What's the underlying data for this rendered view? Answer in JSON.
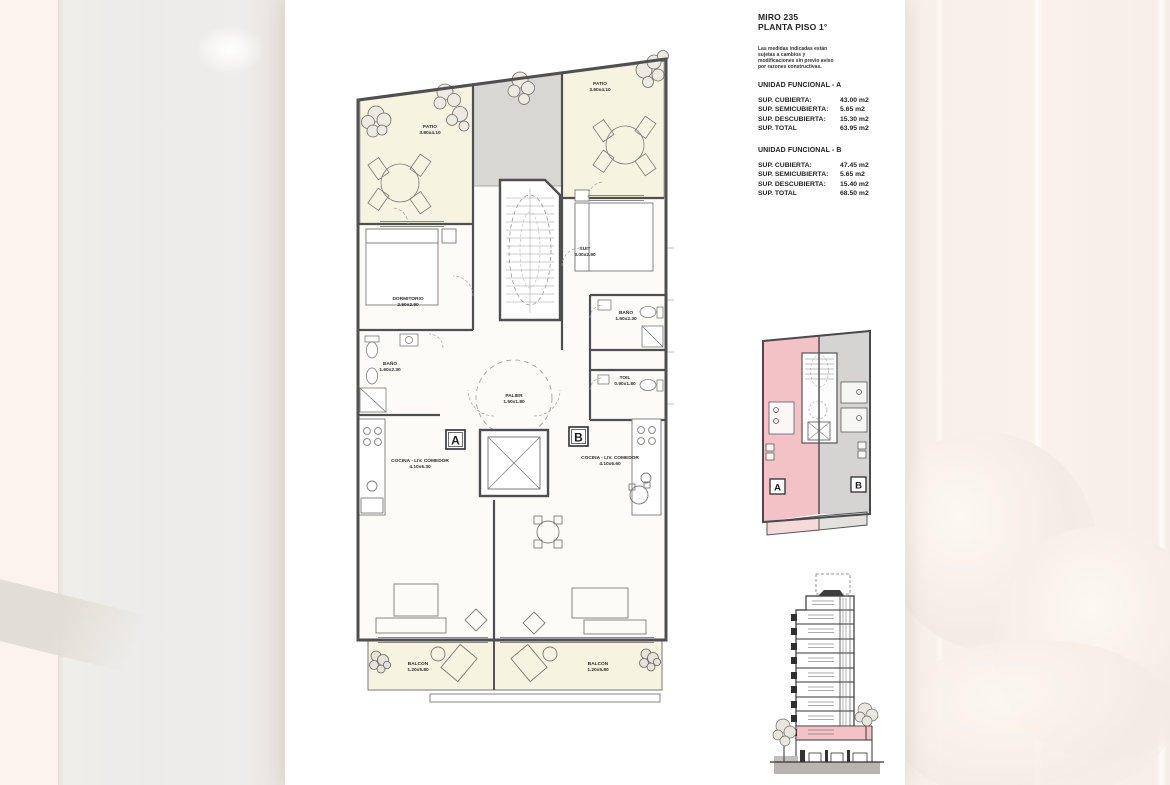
{
  "title_block": {
    "project": "MIRO 235",
    "sheet": "PLANTA PISO 1°",
    "disclaimer_lines": [
      "Las medidas indicadas están",
      "sujetas a cambios y",
      "modificaciones sin previo aviso",
      "por razones constructivas."
    ]
  },
  "units": [
    {
      "heading": "UNIDAD FUNCIONAL - A",
      "rows": [
        {
          "label": "SUP. CUBIERTA:",
          "value": "43.00 m2"
        },
        {
          "label": "SUP. SEMICUBIERTA:",
          "value": "5.65 m2"
        },
        {
          "label": "SUP. DESCUBIERTA:",
          "value": "15.30 m2"
        },
        {
          "label": "SUP. TOTAL",
          "value": "63.95 m2"
        }
      ]
    },
    {
      "heading": "UNIDAD FUNCIONAL - B",
      "rows": [
        {
          "label": "SUP. CUBIERTA:",
          "value": "47.45 m2"
        },
        {
          "label": "SUP. SEMICUBIERTA:",
          "value": "5.65 m2"
        },
        {
          "label": "SUP. DESCUBIERTA:",
          "value": "15.40 m2"
        },
        {
          "label": "SUP. TOTAL",
          "value": "68.50 m2"
        }
      ]
    }
  ],
  "plan": {
    "rooms": {
      "patio_a": {
        "name": "PATIO",
        "dim": "3.80x4.10"
      },
      "patio_b": {
        "name": "PATIO",
        "dim": "3.60x4.10"
      },
      "dormitorio": {
        "name": "DORMITORIO",
        "dim": "2.50x2.90"
      },
      "suit": {
        "name": "SUIT",
        "dim": "3.00x2.90"
      },
      "bano_a": {
        "name": "BAÑO",
        "dim": "1.60x2.30"
      },
      "bano_b": {
        "name": "BAÑO",
        "dim": "1.60x2.30"
      },
      "toil": {
        "name": "TOIL",
        "dim": "0.90x1.80"
      },
      "palier": {
        "name": "PALIER",
        "dim": "1.50x1.80"
      },
      "cocina_a": {
        "name": "COCINA - LIV. COMEDOR",
        "dim": "4.10x6.30"
      },
      "cocina_b": {
        "name": "COCINA - LIV. COMEDOR",
        "dim": "4.10x6.60"
      },
      "balcon_a": {
        "name": "BALCON",
        "dim": "1.20x5.80"
      },
      "balcon_b": {
        "name": "BALCON",
        "dim": "1.20x5.80"
      }
    },
    "marker_a": "A",
    "marker_b": "B"
  },
  "key_plan": {
    "marker_a": "A",
    "marker_b": "B"
  },
  "colors": {
    "unit_a_highlight": "#f3c2c6",
    "unit_b_gray": "#d5d4d2",
    "patio_cream": "#f7f3e1",
    "wall": "#4f4f4f"
  }
}
